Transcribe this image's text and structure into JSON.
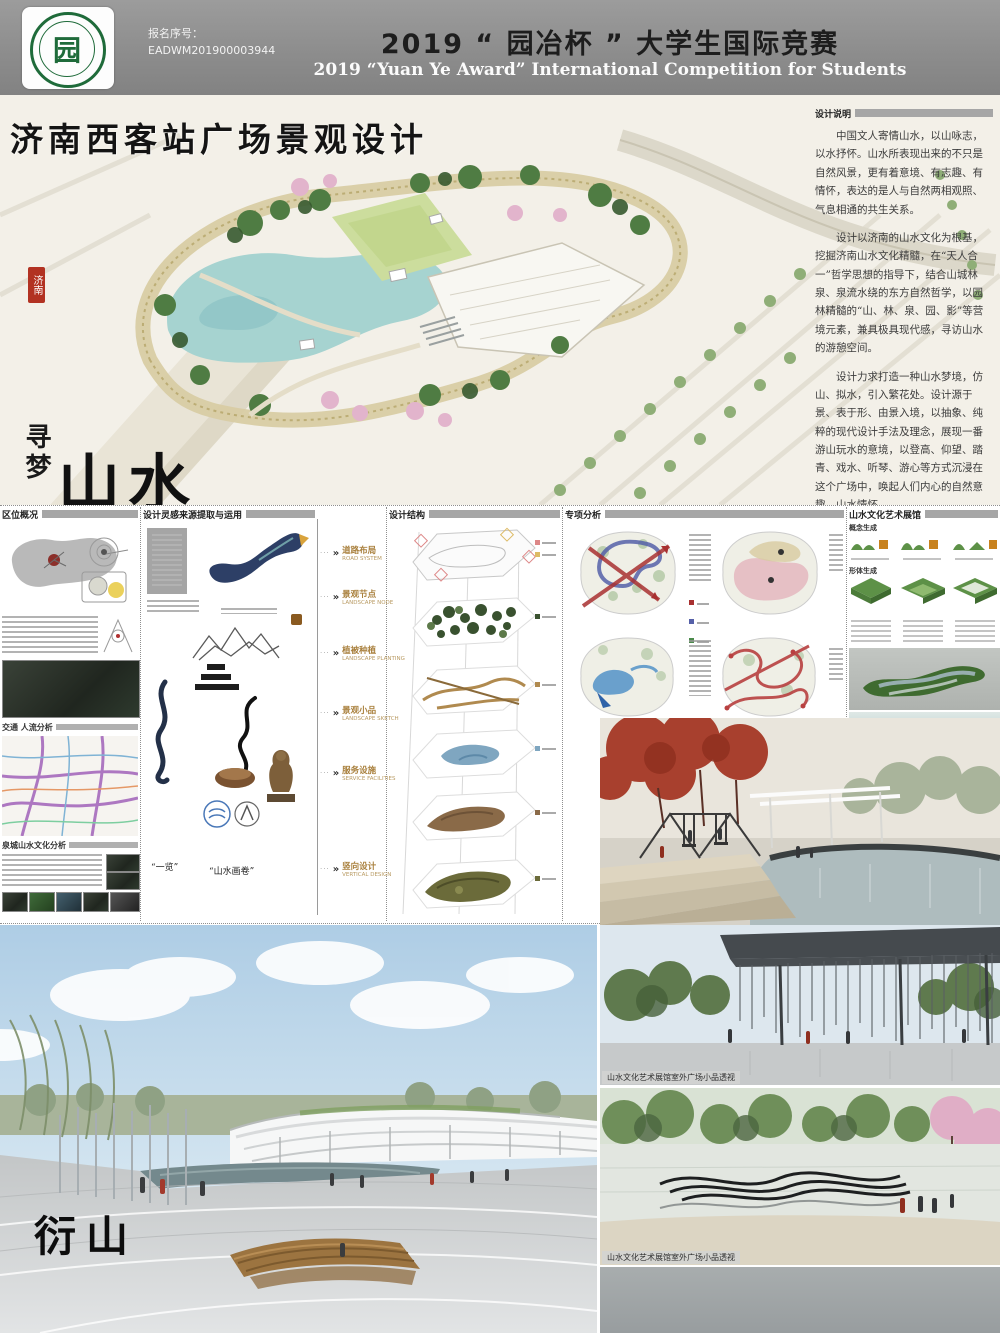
{
  "header": {
    "reg_label": "报名序号：",
    "reg_number": "EADWM201900003944",
    "title_cn": "2019 “ 园冶杯 ” 大学生国际竞赛",
    "title_en": "2019 “Yuan Ye Award” International Competition for  Students",
    "logo_char": "园"
  },
  "masterplan": {
    "project_title": "济南西客站广场景观设计",
    "seal": "济南",
    "slogan_small": "寻梦",
    "slogan_large": "山水",
    "description_title": "设计说明",
    "paragraphs": {
      "p1": "中国文人寄情山水，以山咏志，以水抒怀。山水所表现出来的不只是自然风景，更有着意境、有志趣、有情怀，表达的是人与自然两相观照、气息相通的共生关系。",
      "p2": "设计以济南的山水文化为根基，挖掘济南山水文化精髓，在“天人合一”哲学思想的指导下，结合山城林泉、泉流水绕的东方自然哲学，以园林精髓的“山、林、泉、园、影”等营境元素，兼具极具现代感，寻访山水的游憩空间。",
      "p3": "设计力求打造一种山水梦境，仿山、拟水，引入繁花处。设计源于景、表于形、由景入境，以抽象、纯粹的现代设计手法及理念，展现一番游山玩水的意境，以登高、仰望、踏青、戏水、听琴、游心等方式沉浸在这个广场中，唤起人们内心的自然意趣，山水情怀。"
    }
  },
  "strip": {
    "col1": {
      "header": "区位概况",
      "sub1": "交通 人流分析",
      "sub2": "泉城山水文化分析"
    },
    "col2": {
      "header": "设计灵感来源提取与运用",
      "cap1": "“一览”",
      "cap2": "“山水画卷”"
    },
    "labels": [
      {
        "cn": "道路布局",
        "en": "ROAD SYSTEM"
      },
      {
        "cn": "景观节点",
        "en": "LANDSCAPE NODE"
      },
      {
        "cn": "植被种植",
        "en": "LANDSCAPE PLANTING"
      },
      {
        "cn": "景观小品",
        "en": "LANDSCAPE SKETCH"
      },
      {
        "cn": "服务设施",
        "en": "SERVICE FACILITIES"
      },
      {
        "cn": "竖向设计",
        "en": "VERTICAL DESIGN"
      }
    ],
    "col3": {
      "header": "设计结构"
    },
    "col4": {
      "header": "专项分析"
    },
    "col5": {
      "header": "山水文化艺术展馆",
      "sub1": "概念生成",
      "sub2": "形体生成",
      "caption": "“云水入境” 景观小品"
    }
  },
  "renders": {
    "left_slogan": "衍山",
    "pergola_caption": "山水文化艺术展馆室外广场小品透视",
    "sculpture_caption": "山水文化艺术展馆室外广场小品透视"
  },
  "colors": {
    "accent_green": "#1f6b3a",
    "seal_red": "#b23222",
    "water_teal": "#a6d3d0",
    "label_gold": "#a9803d"
  }
}
